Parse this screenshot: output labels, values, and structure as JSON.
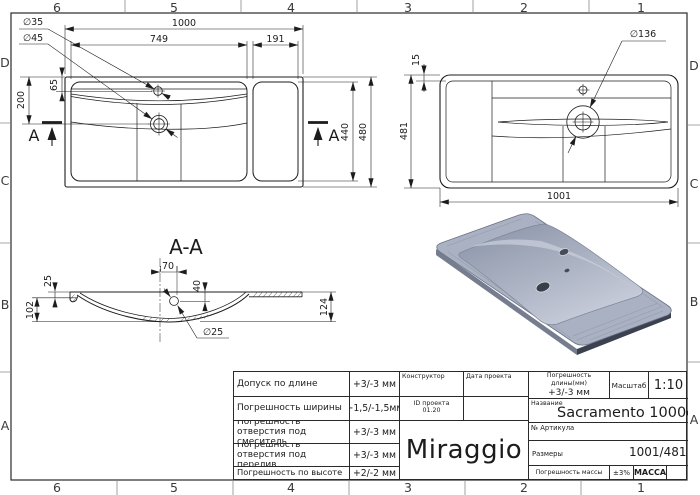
{
  "frame": {
    "top_labels": [
      "6",
      "5",
      "4",
      "3",
      "2",
      "1"
    ],
    "bottom_labels": [
      "6",
      "5",
      "4",
      "3",
      "2",
      "1"
    ],
    "left_labels": [
      "D",
      "C",
      "B",
      "A"
    ],
    "right_labels": [
      "D",
      "C",
      "B",
      "A"
    ]
  },
  "front_view": {
    "dim_width_total": "1000",
    "dim_width_basin": "749",
    "dim_width_shelf": "191",
    "dim_faucet_dia": "∅35",
    "dim_drain_dia": "∅45",
    "dim_faucet_offset": "65",
    "dim_drain_offset": "200",
    "dim_height_inner": "440",
    "dim_height_total": "480",
    "section_letter_left": "A",
    "section_letter_right": "A"
  },
  "top_view": {
    "dim_rim": "15",
    "dim_depth": "481",
    "dim_width": "1001",
    "dim_recess_dia": "∅136"
  },
  "section_view": {
    "title": "A-A",
    "dim_rim_thickness": "25",
    "dim_bowl_depth": "102",
    "dim_drain_offset": "70",
    "dim_drain_depth": "40",
    "dim_total_height": "124",
    "dim_drain_dia": "∅25"
  },
  "render": {
    "body_color": "#a9b1c2"
  },
  "title_block": {
    "tolerances": [
      {
        "label": "Допуск по длине",
        "value": "+3/-3 мм"
      },
      {
        "label": "Погрешность ширины",
        "value": "+1,5/-1,5мм"
      },
      {
        "label": "Погрешность отверстия под смеситель",
        "value": "+3/-3 мм"
      },
      {
        "label": "Погрешность отверстия под перелив",
        "value": "+3/-3 мм"
      },
      {
        "label": "Погрешность по высоте",
        "value": "+2/-2 мм"
      }
    ],
    "designer_label": "Конструктор",
    "project_date_label": "Дата проекта",
    "project_id_label": "ID проекта",
    "project_id_value": "01.20",
    "logo_text": "Miraggio",
    "length_tol_label": "Погрешность длины(мм)",
    "length_tol_value": "+3/-3 мм",
    "scale_label": "Масштаб",
    "scale_value": "1:10",
    "name_label": "Название",
    "name_value": "Sacramento 1000c",
    "article_label": "№ Артикула",
    "size_label": "Размеры",
    "size_value": "1001/481",
    "mass_tol_label": "Погрешность массы",
    "mass_tol_value": "±3%",
    "mass_label": "МАССА"
  }
}
